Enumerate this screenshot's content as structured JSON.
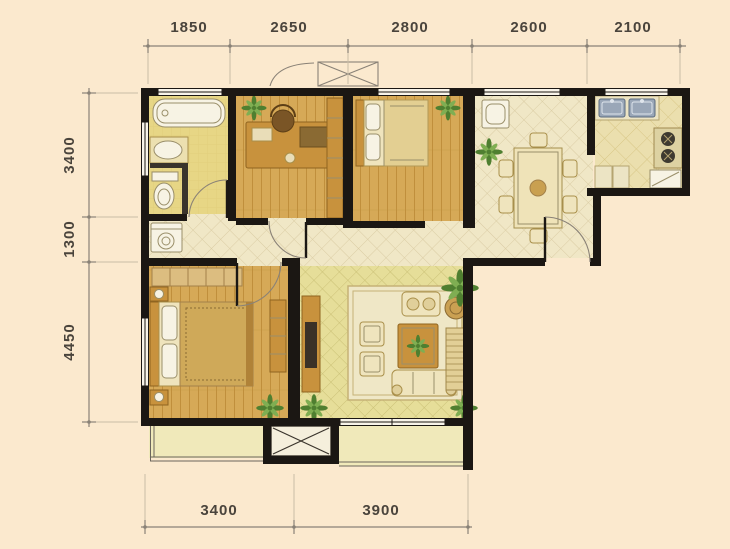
{
  "dims": {
    "top": [
      "1850",
      "2650",
      "2800",
      "2600",
      "2100"
    ],
    "left": [
      "3400",
      "1300",
      "4450"
    ],
    "bottom": [
      "3400",
      "3900"
    ]
  },
  "colors": {
    "bg": "#fbe9ce",
    "wall": "#1b1713",
    "dim": "#8a8277",
    "dimext": "#c9bda6",
    "dimtext": "#4a443c",
    "wood": "#d6a957",
    "woodline": "#c08f3c",
    "bath": "#e7d685",
    "bathline": "#d9c26c",
    "tile": "#f0e7c6",
    "tileline": "#d9cba2",
    "livtile": "#e6de99",
    "livline": "#c9bf74",
    "kittile": "#ebdfae",
    "kitline": "#d8c686",
    "balc": "#f0e9ba",
    "furnwood": "#c8923d",
    "furnwooddark": "#8f6420",
    "fabric": "#efe4bd",
    "fabricline": "#a98f4a",
    "white": "#f7f3e4",
    "fixline": "#9a8f6a",
    "sink": "#9aa7b8",
    "plantdark": "#4f7f30",
    "plantlight": "#7fae52",
    "rug": "#efe7c6",
    "rugline": "#c5b277",
    "gold": "#cfa959"
  }
}
